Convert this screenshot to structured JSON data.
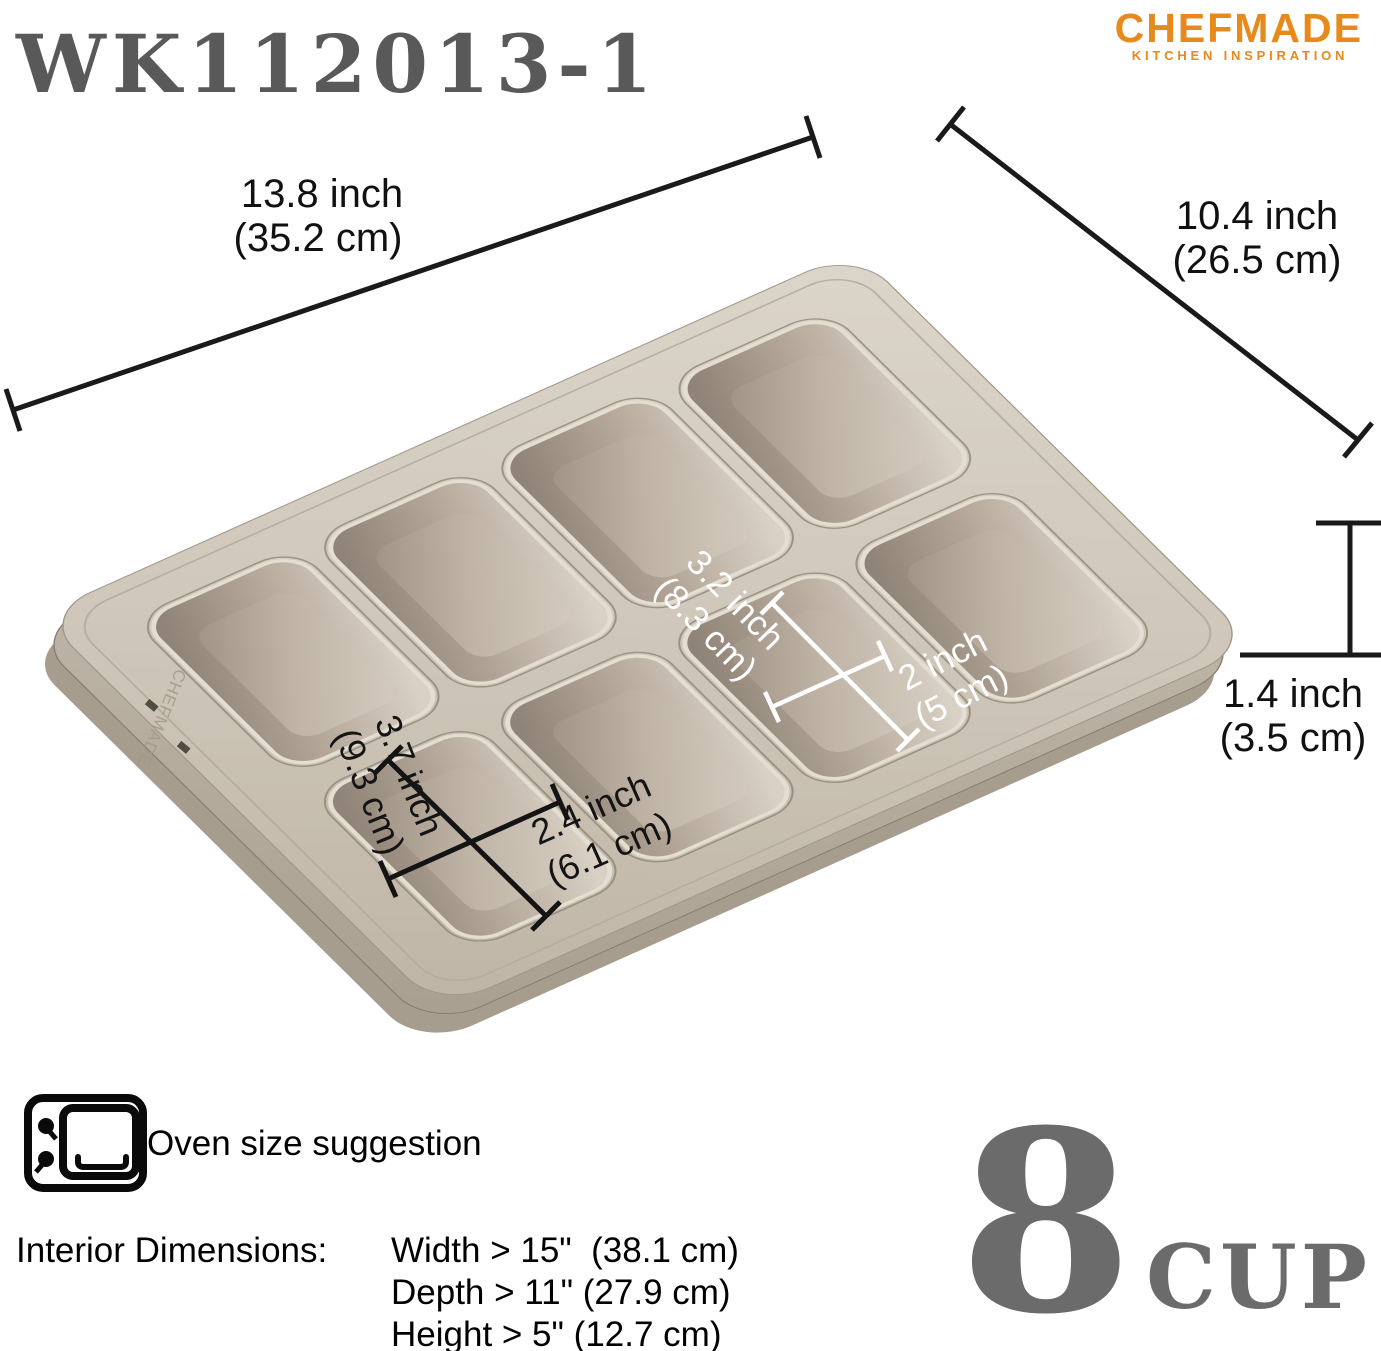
{
  "header": {
    "product_code": "WK112013-1"
  },
  "brand": {
    "name": "CHEFMADE",
    "tagline": "KITCHEN INSPIRATION",
    "color": "#E8891C"
  },
  "annotations": {
    "overall_length": {
      "inch": "13.8 inch",
      "cm": "(35.2 cm)"
    },
    "overall_width": {
      "inch": "10.4 inch",
      "cm": "(26.5 cm)"
    },
    "pan_height": {
      "inch": "1.4 inch",
      "cm": "(3.5 cm)"
    },
    "cup_bottom_length": {
      "inch": "3.2 inch",
      "cm": "(8.3 cm)"
    },
    "cup_bottom_width": {
      "inch": "2 inch",
      "cm": "(5 cm)"
    },
    "cup_top_length": {
      "inch": "3.7 inch",
      "cm": "(9.3 cm)"
    },
    "cup_top_width": {
      "inch": "2.4 inch",
      "cm": "(6.1 cm)"
    }
  },
  "pan": {
    "emboss_text": "CHEFMADE",
    "cup_count": 8,
    "color_top": "#D2CABF",
    "color_cavity_dark": "#8E8376",
    "color_side": "#B2A899"
  },
  "oven_suggestion": {
    "title": "Oven size suggestion",
    "label": "Interior Dimensions:",
    "width_line": "Width > 15\"  (38.1 cm)",
    "depth_line": "Depth > 11\" (27.9 cm)",
    "height_line": "Height > 5\" (12.7 cm)"
  },
  "capacity": {
    "number": "8",
    "unit": "CUP"
  }
}
